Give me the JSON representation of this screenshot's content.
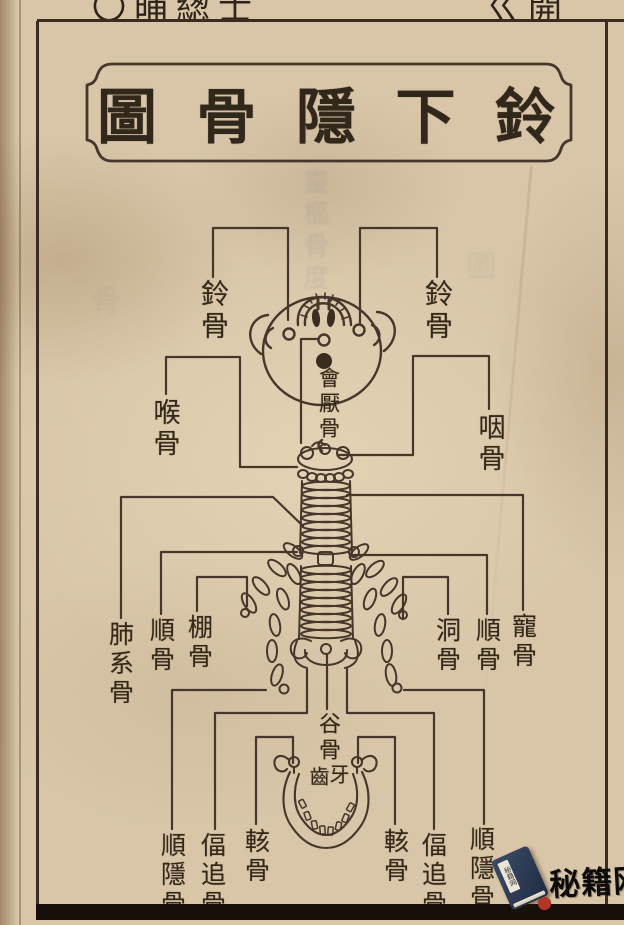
{
  "page": {
    "paper_color": "#d9c6a8",
    "ink_color": "#3a2d1f",
    "top_edge_fragments": {
      "left": "〇晡緫士",
      "right": "ㄍ開"
    },
    "bleedthrough_artifacts": {
      "center_column": "靈樞骨度",
      "left_patch": "骨",
      "right_patch": "圖"
    }
  },
  "title": {
    "reading_right_to_left": "鈴下隱骨圖",
    "chars_ltr": [
      "圖",
      "骨",
      "隱",
      "下",
      "鈴"
    ]
  },
  "diagram": {
    "labels": [
      {
        "id": "ling-gu-left",
        "text": "鈴骨"
      },
      {
        "id": "ling-gu-right",
        "text": "鈴骨"
      },
      {
        "id": "hou-gu",
        "text": "喉骨"
      },
      {
        "id": "yan-gu",
        "text": "咽骨"
      },
      {
        "id": "hui-yan-gu",
        "text": "會厭骨"
      },
      {
        "id": "fei-xi-gu",
        "text": "肺系骨"
      },
      {
        "id": "shun-gu-left",
        "text": "順骨"
      },
      {
        "id": "peng-gu",
        "text": "棚骨"
      },
      {
        "id": "dong-gu",
        "text": "洞骨"
      },
      {
        "id": "shun-gu-right",
        "text": "順骨"
      },
      {
        "id": "chong-gu",
        "text": "寵骨"
      },
      {
        "id": "gu-gu",
        "text": "谷骨"
      },
      {
        "id": "teeth-left-char",
        "text": "齒"
      },
      {
        "id": "teeth-right-char",
        "text": "牙"
      },
      {
        "id": "shun-yin-gu-left",
        "text": "順隱骨"
      },
      {
        "id": "bi-zhui-gu-left",
        "text": "偪追骨"
      },
      {
        "id": "kai-gu-left",
        "text": "輆骨"
      },
      {
        "id": "kai-gu-right",
        "text": "輆骨"
      },
      {
        "id": "bi-zhui-gu-right",
        "text": "偪追骨"
      },
      {
        "id": "shun-yin-gu-right",
        "text": "順隱骨"
      }
    ]
  },
  "watermark": {
    "site_name": "秘籍网",
    "book_icon": "book-icon",
    "book_cover_color": "#2e3d56",
    "seal_color": "#b23527"
  }
}
